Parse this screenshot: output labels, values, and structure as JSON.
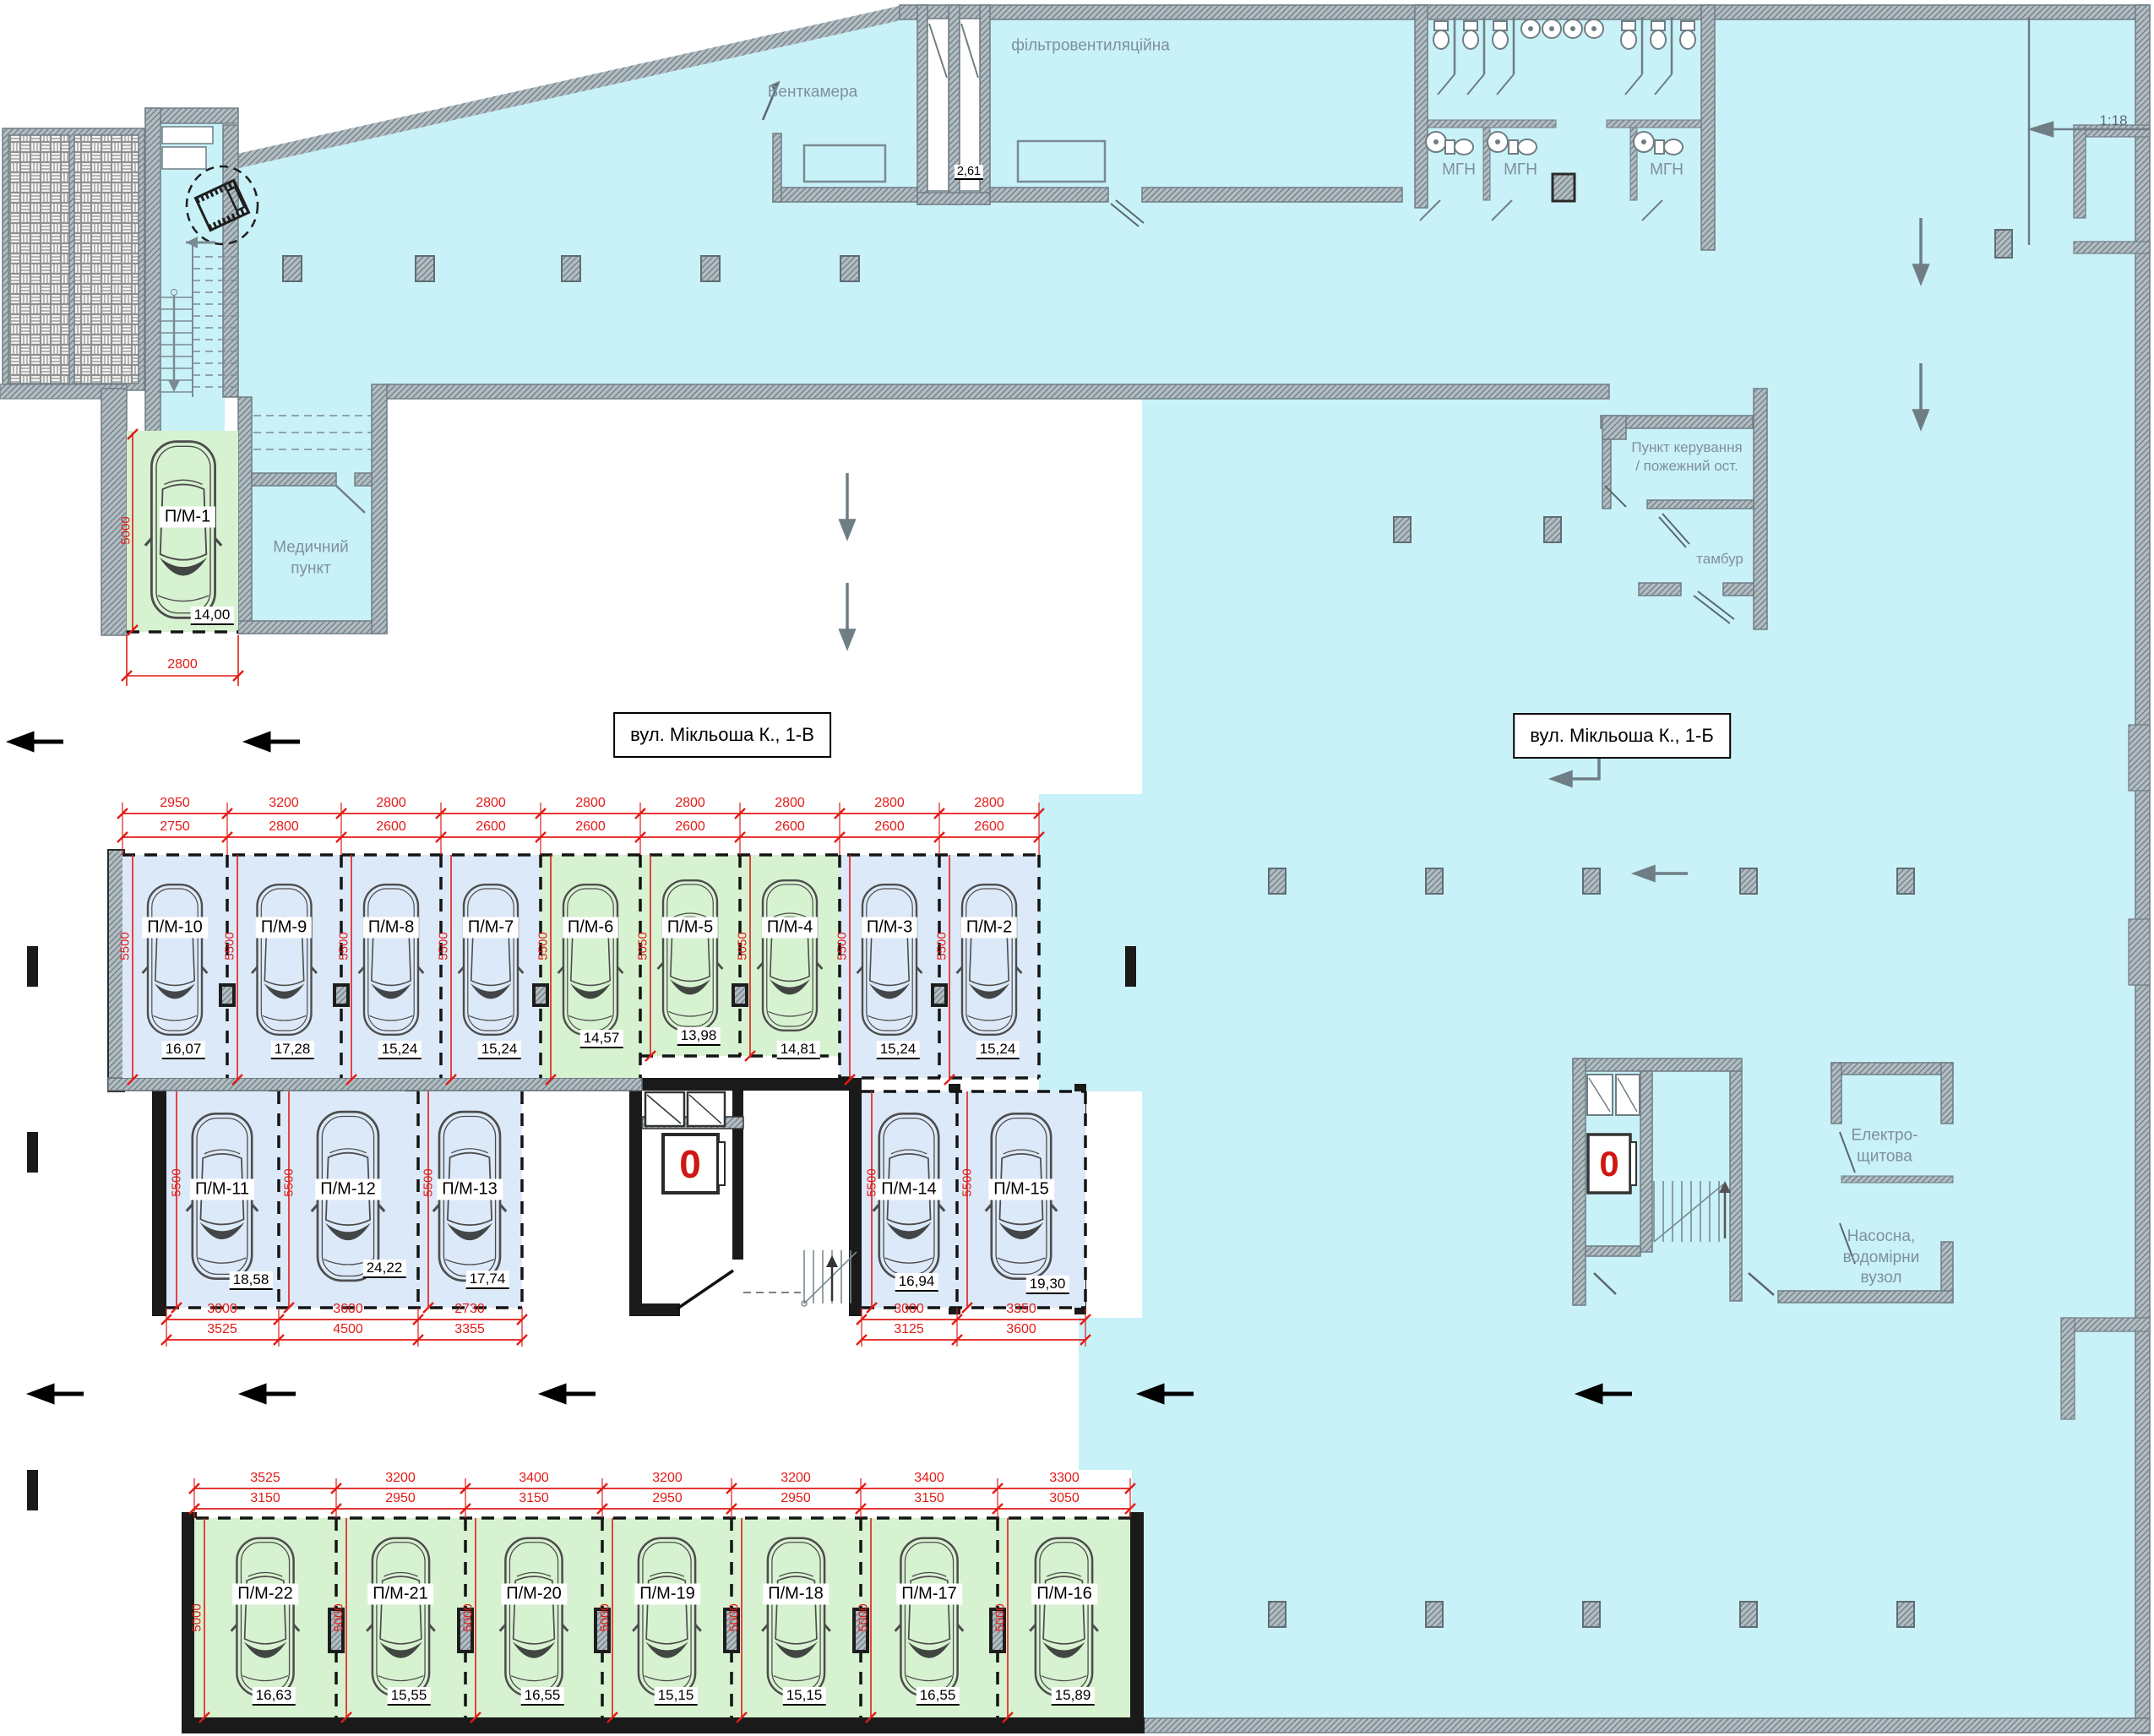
{
  "streets": {
    "left_box": "вул. Мікльоша К., 1-В",
    "right_box": "вул. Мікльоша К., 1-Б"
  },
  "rooms": {
    "ventkamera": "Венткамера",
    "filter_vent": "фільтровентиляційна",
    "mgn1": "МГН",
    "mgn2": "МГН",
    "mgn3": "МГН",
    "medical": "Медичний\nпункт",
    "control": "Пункт керування\n/ пожежний ост.",
    "tambur": "тамбур",
    "electro": "Електро-\nщитова",
    "pump": "Насосна,\nводомірни\nвузол"
  },
  "annotations": {
    "ramp_slope": "1:18",
    "shaft_dim": "2,61",
    "elevator_floor_left": "0",
    "elevator_floor_right": "0"
  },
  "pm1": {
    "label": "П/М-1",
    "area": "14,00",
    "width_dim": "2800",
    "depth_dim": "5000"
  },
  "top_row": {
    "stalls": [
      {
        "label": "П/М-10",
        "area": "16,07",
        "outer": "2950",
        "inner": "2750",
        "depth": "5500",
        "color": "blue"
      },
      {
        "label": "П/М-9",
        "area": "17,28",
        "outer": "3200",
        "inner": "2800",
        "depth": "5500",
        "color": "blue"
      },
      {
        "label": "П/М-8",
        "area": "15,24",
        "outer": "2800",
        "inner": "2600",
        "depth": "5500",
        "color": "blue"
      },
      {
        "label": "П/М-7",
        "area": "15,24",
        "outer": "2800",
        "inner": "2600",
        "depth": "5500",
        "color": "blue"
      },
      {
        "label": "П/М-6",
        "area": "14,57",
        "outer": "2800",
        "inner": "2600",
        "depth": "5500",
        "color": "green"
      },
      {
        "label": "П/М-5",
        "area": "13,98",
        "outer": "2800",
        "inner": "2600",
        "depth": "5050",
        "color": "green"
      },
      {
        "label": "П/М-4",
        "area": "14,81",
        "outer": "2800",
        "inner": "2600",
        "depth": "5050",
        "color": "green"
      },
      {
        "label": "П/М-3",
        "area": "15,24",
        "outer": "2800",
        "inner": "2600",
        "depth": "5500",
        "color": "blue"
      },
      {
        "label": "П/М-2",
        "area": "15,24",
        "outer": "2800",
        "inner": "2600",
        "depth": "5500",
        "color": "blue"
      }
    ]
  },
  "middle_row": {
    "stalls": [
      {
        "label": "П/М-11",
        "area": "18,58",
        "inner": "3000",
        "outer": "3525",
        "depth": "5500"
      },
      {
        "label": "П/М-12",
        "area": "24,22",
        "inner": "3600",
        "outer": "4500",
        "depth": "5500"
      },
      {
        "label": "П/М-13",
        "area": "17,74",
        "inner": "2730",
        "outer": "3355",
        "depth": "5500"
      },
      {
        "label": "П/М-14",
        "area": "16,94",
        "inner": "3000",
        "outer": "3125",
        "depth": "5500"
      },
      {
        "label": "П/М-15",
        "area": "19,30",
        "inner": "3350",
        "outer": "3600",
        "depth": "5500"
      }
    ]
  },
  "bottom_row": {
    "stalls": [
      {
        "label": "П/М-22",
        "area": "16,63",
        "outer": "3525",
        "inner": "3150",
        "depth": "5000"
      },
      {
        "label": "П/М-21",
        "area": "15,55",
        "outer": "3200",
        "inner": "2950",
        "depth": "5000"
      },
      {
        "label": "П/М-20",
        "area": "16,55",
        "outer": "3400",
        "inner": "3150",
        "depth": "5000"
      },
      {
        "label": "П/М-19",
        "area": "15,15",
        "outer": "3200",
        "inner": "2950",
        "depth": "5000"
      },
      {
        "label": "П/М-18",
        "area": "15,15",
        "outer": "3200",
        "inner": "2950",
        "depth": "5000"
      },
      {
        "label": "П/М-17",
        "area": "16,55",
        "outer": "3400",
        "inner": "3150",
        "depth": "5000"
      },
      {
        "label": "П/М-16",
        "area": "15,89",
        "outer": "3300",
        "inner": "3050",
        "depth": "5000"
      }
    ]
  },
  "colors": {
    "cyan": "#c9f1f8",
    "stall_blue": "#dce9f8",
    "stall_green": "#d7f2d0",
    "dim_red": "#e31b17",
    "wall_gray": "#97a4ab",
    "wall_black": "#1a1a1a",
    "room_text": "#7e909b"
  }
}
